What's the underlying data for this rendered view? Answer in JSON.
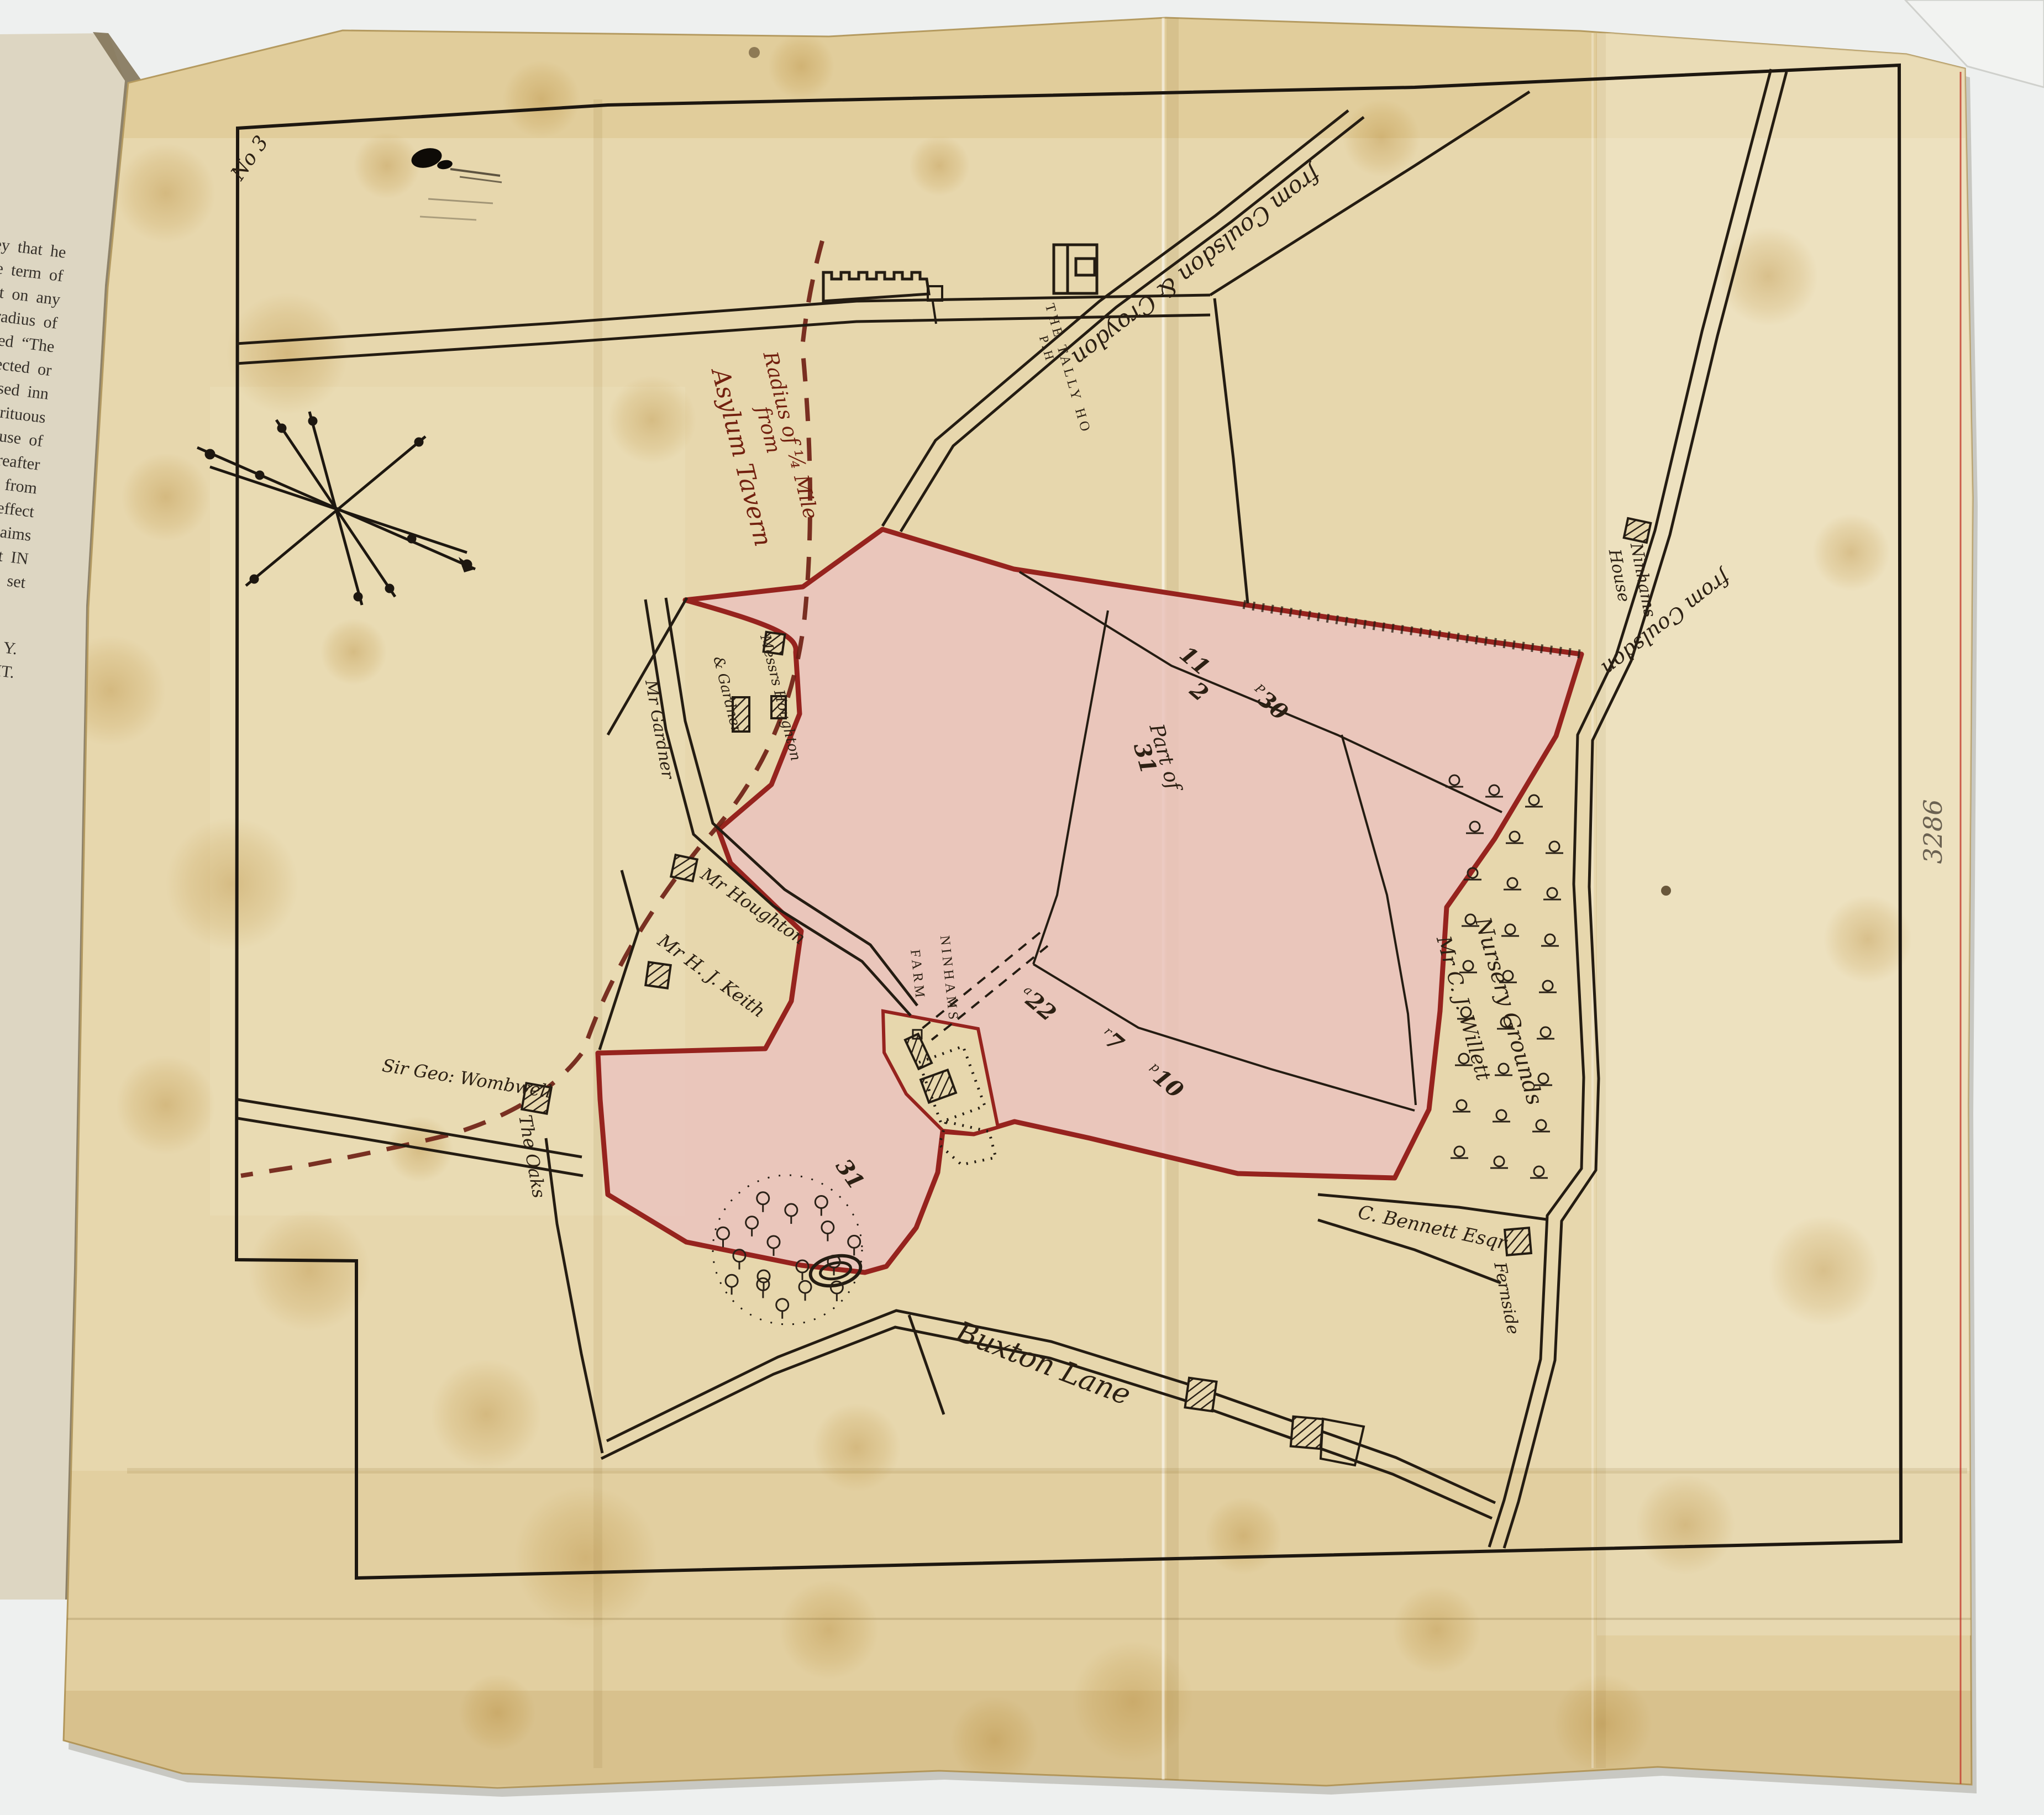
{
  "book_page": {
    "lines": [
      "sley that he",
      "the term of",
      "erect on any",
      "radius of",
      "lled “The",
      "erected or",
      "ensed inn",
      "spirituous",
      "house of",
      "hereafter",
      "ts from",
      "e effect",
      "claims",
      "nt IN",
      "to set",
      "Y.",
      "HT."
    ]
  },
  "map": {
    "sheet_number": "3286",
    "corner_mark": "No 3",
    "ink_colors": {
      "ink": "#2c2013",
      "radius_ink": "#72200f",
      "parcel_fill": "#eac3bd",
      "parcel_border": "#96231e"
    },
    "labels": {
      "radius_line1": "Radius of ¼ Mile",
      "radius_line2": "from",
      "radius_line3": "Asylum Tavern",
      "road_from_coulsdon_croydon": "from Coulsdon & Croydon",
      "tally_ho": "THE TALLY HO",
      "tally_ho_line2": "P.H.",
      "ninhams_house_line1": "Ninhams",
      "ninhams_house_line2": "House",
      "road_from_coulsdon": "from Coulsdon",
      "messrs_line1": "Messrs Houghton",
      "messrs_line2": "& Gardner",
      "mr_gardner": "Mr Gardner",
      "mr_houghton": "Mr Houghton",
      "mr_keith": "Mr H. J. Keith",
      "ninhams_farm_line1": "NINHAMS",
      "ninhams_farm_line2": "FARM",
      "wombwell": "Sir Geo: Wombwell",
      "the_oaks": "The Oaks",
      "buxton_lane": "Buxton Lane",
      "bennett": "C. Bennett Esqr",
      "fernside": "Fernside",
      "nursery_line1": "Nursery Grounds",
      "nursery_line2": "Mr C. J. Willett"
    },
    "parcel_numbers": {
      "n11": "11",
      "n2": "2",
      "n30": "30",
      "n30_sup": "P",
      "part_of": "Part of",
      "n31": "31",
      "n22": "22",
      "n22_sup": "a",
      "n7": "7",
      "n7_sup": "r",
      "n10": "10",
      "n10_sup": "p",
      "n31_lower": "31"
    }
  }
}
